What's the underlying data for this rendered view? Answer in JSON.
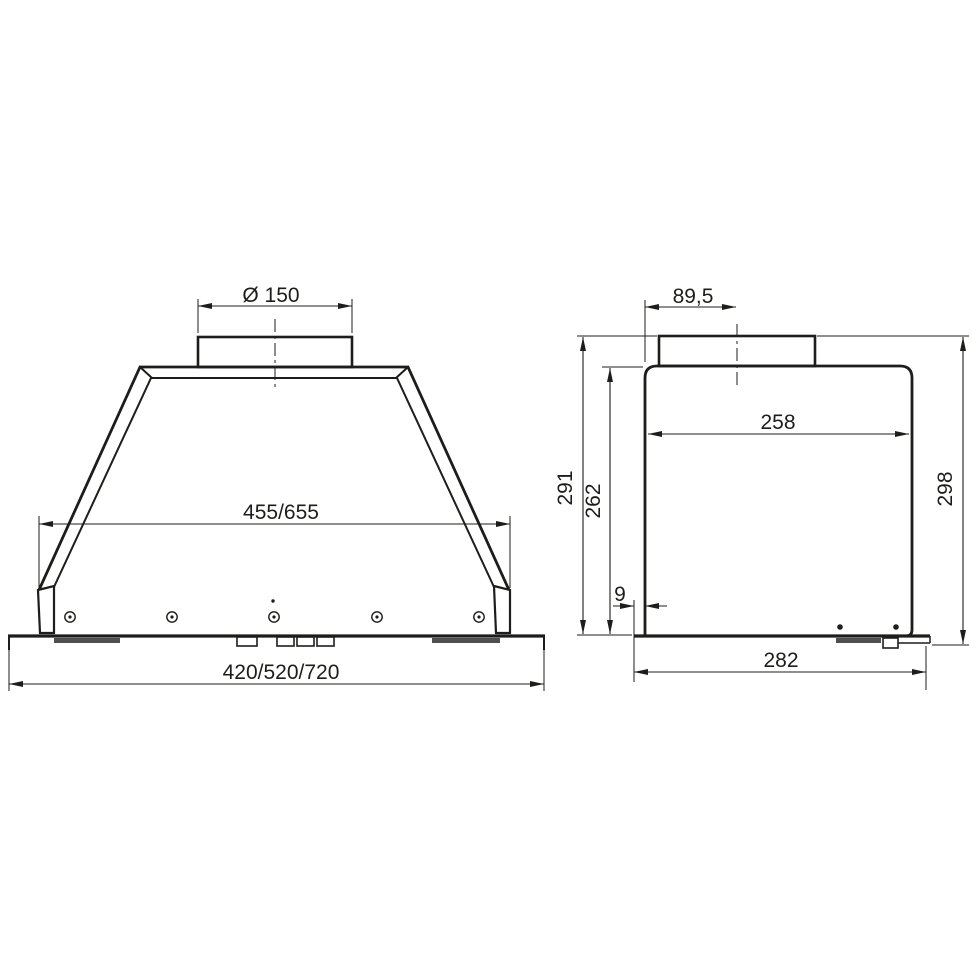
{
  "drawing": {
    "kind": "technical-dimensional-drawing",
    "views": [
      "front",
      "side"
    ]
  },
  "front": {
    "duct_diameter": "Ø 150",
    "body_width": "455/655",
    "overall_width": "420/520/720"
  },
  "side": {
    "duct_offset": "89,5",
    "inner_depth": "258",
    "height_to_duct": "291",
    "body_height": "262",
    "bottom_overhang": "9",
    "base_depth": "282",
    "overall_height": "298"
  },
  "colors": {
    "line": "#1d1d1b",
    "gasket": "#4f4f4f",
    "background": "#ffffff"
  }
}
